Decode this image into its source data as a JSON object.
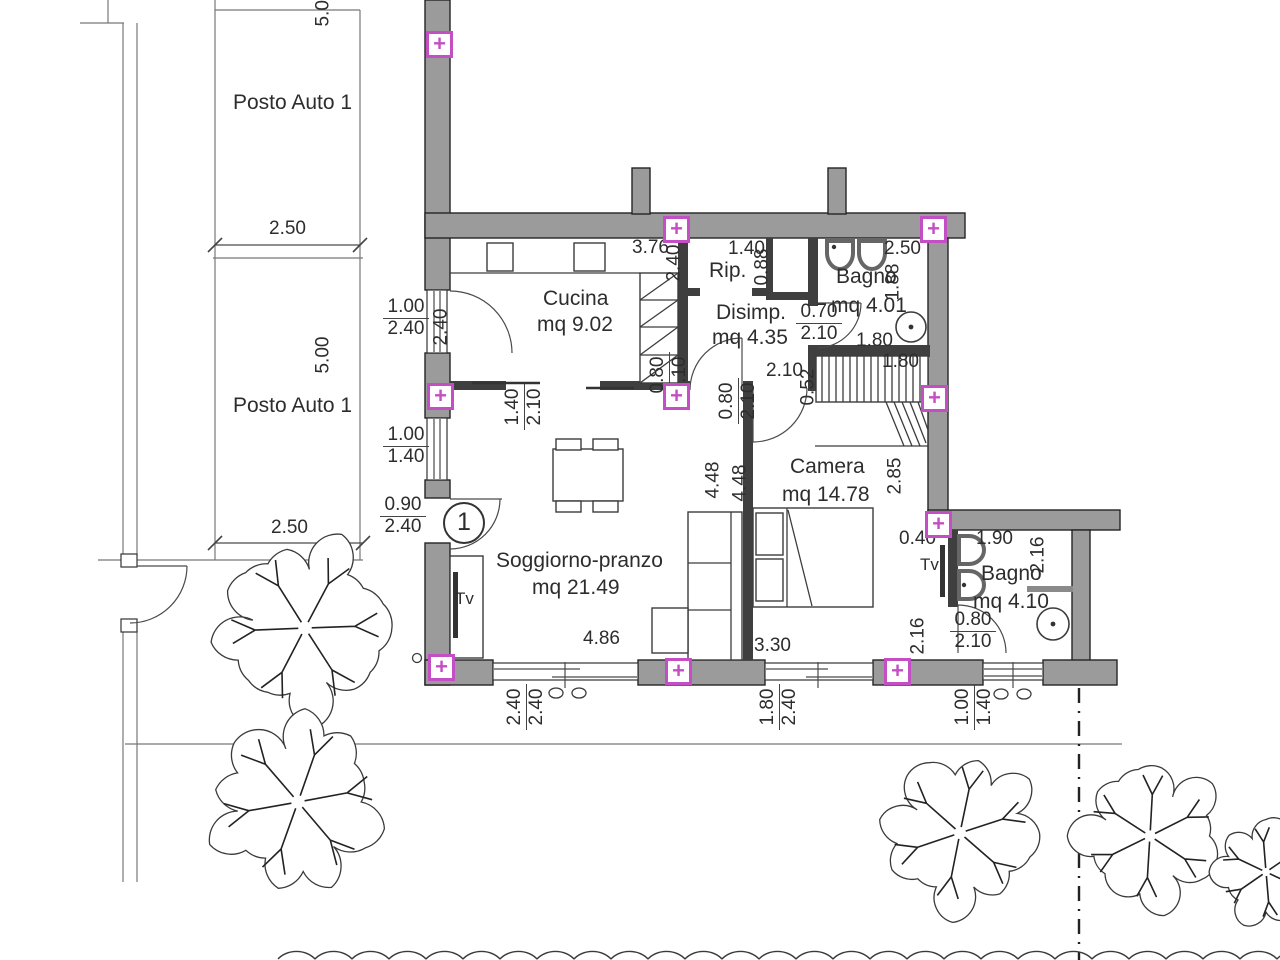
{
  "unit": {
    "number": "1"
  },
  "marker_glyph": "+",
  "colors": {
    "wall": "#9b9b9b",
    "interior_wall": "#3f3f3f",
    "marker": "#c44fc4",
    "line": "#4a4a4a",
    "text": "#2d2d2d"
  },
  "rooms_summary": [
    {
      "name": "Posto Auto 1"
    },
    {
      "name": "Posto Auto 1"
    },
    {
      "name": "Cucina",
      "area": "mq 9.02"
    },
    {
      "name": "Rip."
    },
    {
      "name": "Bagno",
      "area": "mq 4.01"
    },
    {
      "name": "Disimp.",
      "area": "mq 4.35"
    },
    {
      "name": "Camera",
      "area": "mq 14.78"
    },
    {
      "name": "Soggiorno-pranzo",
      "area": "mq 21.49"
    },
    {
      "name": "Bagno",
      "area": "mq 4.10"
    }
  ],
  "labels": [
    {
      "id": "room-posto-auto-1a",
      "text": "Posto Auto 1",
      "x": 233,
      "y": 92,
      "cls": "room"
    },
    {
      "id": "room-posto-auto-1b",
      "text": "Posto Auto 1",
      "x": 233,
      "y": 395,
      "cls": "room"
    },
    {
      "id": "dim-stall-top",
      "text": "2.50",
      "x": 269,
      "y": 219
    },
    {
      "id": "dim-stall-bottom",
      "text": "2.50",
      "x": 271,
      "y": 518
    },
    {
      "id": "dim-stall-depth-top",
      "text": "5.0",
      "x": 334,
      "y": 6,
      "rot": true
    },
    {
      "id": "dim-stall-depth",
      "text": "5.00",
      "x": 334,
      "y": 353,
      "rot": true
    },
    {
      "id": "dim-cucina-width",
      "text": "3.76",
      "x": 632,
      "y": 238
    },
    {
      "id": "dim-rip-width",
      "text": "1.40",
      "x": 728,
      "y": 239
    },
    {
      "id": "room-rip",
      "text": "Rip.",
      "x": 709,
      "y": 260,
      "cls": "room"
    },
    {
      "id": "dim-rip-depth",
      "text": "2.40",
      "x": 685,
      "y": 261,
      "rot": true
    },
    {
      "id": "dim-shaft",
      "text": "0.88",
      "x": 773,
      "y": 265,
      "rot": true
    },
    {
      "id": "dim-bagno1-width",
      "text": "2.50",
      "x": 884,
      "y": 239
    },
    {
      "id": "room-bagno1",
      "text": "Bagno",
      "x": 836,
      "y": 266,
      "cls": "room"
    },
    {
      "id": "area-bagno1",
      "text": "mq 4.01",
      "x": 831,
      "y": 295,
      "cls": "room"
    },
    {
      "id": "dim-bagno1-depth",
      "text": "1.88",
      "x": 904,
      "y": 280,
      "rot": true
    },
    {
      "id": "dim-bagno1-low",
      "text": "1.80",
      "x": 856,
      "y": 331
    },
    {
      "id": "dim-wardrobe",
      "text": "1.80",
      "x": 882,
      "y": 352
    },
    {
      "id": "room-cucina",
      "text": "Cucina",
      "x": 543,
      "y": 288,
      "cls": "room"
    },
    {
      "id": "area-cucina",
      "text": "mq 9.02",
      "x": 537,
      "y": 314,
      "cls": "room"
    },
    {
      "id": "dim-cucina-door",
      "text": "2.40",
      "x": 452,
      "y": 325,
      "rot": true
    },
    {
      "id": "room-disimp",
      "text": "Disimp.",
      "x": 716,
      "y": 302,
      "cls": "room"
    },
    {
      "id": "area-disimp",
      "text": "mq 4.35",
      "x": 712,
      "y": 327,
      "cls": "room"
    },
    {
      "id": "dim-disimp",
      "text": "2.10",
      "x": 766,
      "y": 361
    },
    {
      "id": "dim-wardrobe-depth",
      "text": "0.52",
      "x": 819,
      "y": 385,
      "rot": true
    },
    {
      "id": "dim-sogg-depth",
      "text": "4.48",
      "x": 724,
      "y": 478,
      "rot": true
    },
    {
      "id": "dim-camera-depth",
      "text": "4.48",
      "x": 751,
      "y": 481,
      "rot": true
    },
    {
      "id": "dim-camera-right",
      "text": "2.85",
      "x": 906,
      "y": 474,
      "rot": true
    },
    {
      "id": "room-camera",
      "text": "Camera",
      "x": 790,
      "y": 456,
      "cls": "room"
    },
    {
      "id": "area-camera",
      "text": "mq 14.78",
      "x": 782,
      "y": 484,
      "cls": "room"
    },
    {
      "id": "room-soggiorno",
      "text": "Soggiorno-pranzo",
      "x": 496,
      "y": 550,
      "cls": "room"
    },
    {
      "id": "area-soggiorno",
      "text": "mq 21.49",
      "x": 532,
      "y": 577,
      "cls": "room"
    },
    {
      "id": "tv-soggiorno",
      "text": "Tv",
      "x": 455,
      "y": 590,
      "cls": "small"
    },
    {
      "id": "tv-camera",
      "text": "Tv",
      "x": 920,
      "y": 556,
      "cls": "small"
    },
    {
      "id": "dim-sogg-width",
      "text": "4.86",
      "x": 583,
      "y": 629
    },
    {
      "id": "dim-camera-width",
      "text": "3.30",
      "x": 754,
      "y": 636
    },
    {
      "id": "dim-stub",
      "text": "0.40",
      "x": 899,
      "y": 529
    },
    {
      "id": "dim-bagno2-width",
      "text": "1.90",
      "x": 976,
      "y": 529
    },
    {
      "id": "dim-bagno2-right",
      "text": "2.16",
      "x": 1049,
      "y": 553,
      "rot": true
    },
    {
      "id": "room-bagno2",
      "text": "Bagno",
      "x": 981,
      "y": 563,
      "cls": "room"
    },
    {
      "id": "area-bagno2",
      "text": "mq 4.10",
      "x": 973,
      "y": 591,
      "cls": "room"
    },
    {
      "id": "dim-bagno2-door-side",
      "text": "2.16",
      "x": 929,
      "y": 634,
      "rot": true
    }
  ],
  "fracs": [
    {
      "id": "win-cucina",
      "num": "1.00",
      "den": "2.40",
      "x": 383,
      "y": 297
    },
    {
      "id": "win-soggiorno-left",
      "num": "1.00",
      "den": "1.40",
      "x": 383,
      "y": 425
    },
    {
      "id": "door-entrance",
      "num": "0.90",
      "den": "2.40",
      "x": 380,
      "y": 495
    },
    {
      "id": "door-bagno1",
      "num": "0.70",
      "den": "2.10",
      "x": 796,
      "y": 302
    },
    {
      "id": "door-bagno2",
      "num": "0.80",
      "den": "2.10",
      "x": 950,
      "y": 610
    },
    {
      "id": "open-cucina-sogg",
      "num": "1.40",
      "den": "2.10",
      "x": 543,
      "y": 390,
      "rot": true
    },
    {
      "id": "door-disimp-sogg",
      "num": "0.80",
      "den": "2.10",
      "x": 688,
      "y": 358,
      "rot": true
    },
    {
      "id": "door-camera",
      "num": "0.80",
      "den": "2.10",
      "x": 757,
      "y": 384,
      "rot": true
    },
    {
      "id": "win-sogg-bottom",
      "num": "2.40",
      "den": "2.40",
      "x": 545,
      "y": 690,
      "rot": true
    },
    {
      "id": "win-camera-bottom",
      "num": "1.80",
      "den": "2.40",
      "x": 798,
      "y": 690,
      "rot": true
    },
    {
      "id": "win-bagno2-bottom",
      "num": "1.00",
      "den": "1.40",
      "x": 993,
      "y": 690,
      "rot": true
    }
  ],
  "markers": [
    {
      "x": 426,
      "y": 31
    },
    {
      "x": 663,
      "y": 216
    },
    {
      "x": 920,
      "y": 216
    },
    {
      "x": 427,
      "y": 383
    },
    {
      "x": 663,
      "y": 383
    },
    {
      "x": 921,
      "y": 385
    },
    {
      "x": 925,
      "y": 511
    },
    {
      "x": 428,
      "y": 654
    },
    {
      "x": 665,
      "y": 658
    },
    {
      "x": 884,
      "y": 658
    }
  ],
  "garden": {
    "trees": [
      {
        "cx": 305,
        "cy": 628,
        "r": 96,
        "s": 1
      },
      {
        "cx": 298,
        "cy": 802,
        "r": 96,
        "s": 4
      },
      {
        "cx": 960,
        "cy": 833,
        "r": 86,
        "s": 7
      },
      {
        "cx": 1150,
        "cy": 836,
        "r": 80,
        "s": 10
      },
      {
        "cx": 1266,
        "cy": 872,
        "r": 58,
        "s": 13
      }
    ],
    "hedge": {
      "y": 959,
      "x1": 278,
      "x2": 1300,
      "step": 37
    }
  }
}
